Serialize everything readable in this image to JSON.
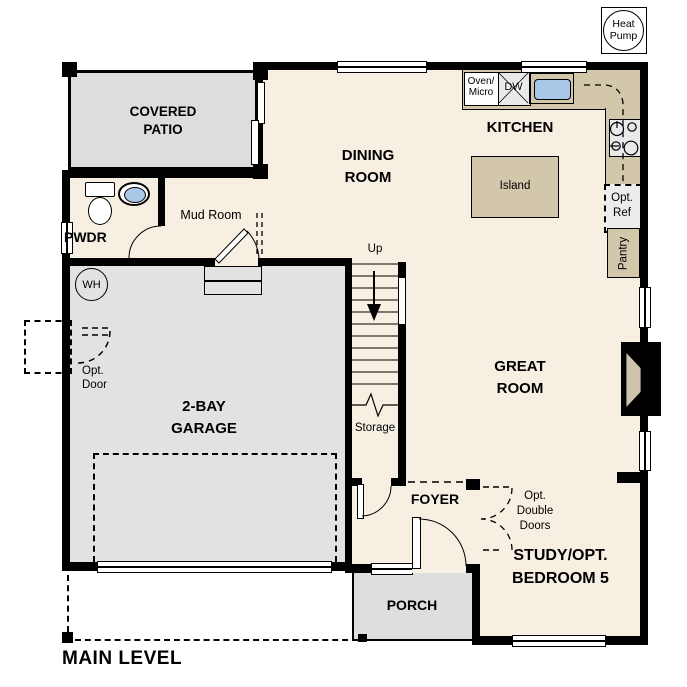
{
  "plan": {
    "title": "MAIN LEVEL",
    "heat_pump_badge": "Heat\nPump",
    "rooms": {
      "covered_patio": "COVERED\nPATIO",
      "powder": "PWDR",
      "mud_room": "Mud Room",
      "dining_room": "DINING\nROOM",
      "kitchen": "KITCHEN",
      "great_room": "GREAT\nROOM",
      "garage": "2-BAY\nGARAGE",
      "storage": "Storage",
      "foyer": "FOYER",
      "porch": "PORCH",
      "study": "STUDY/OPT.\nBEDROOM 5"
    },
    "features": {
      "island": "Island",
      "pantry": "Pantry",
      "opt_ref": "Opt.\nRef",
      "oven_micro": "Oven/\nMicro",
      "dishwasher": "DW",
      "water_heater": "WH",
      "stairs_up": "Up",
      "opt_door": "Opt.\nDoor",
      "opt_double_doors": "Opt.\nDouble\nDoors"
    },
    "colors": {
      "floor": "#f6efe2",
      "patio": "#dddddd",
      "garage": "#e2e2e2",
      "porch": "#dedede",
      "counter": "#d2c6ab",
      "appliance": "#e9e9e9",
      "sink_blue": "#a9c7e7",
      "wall": "#000000"
    }
  }
}
